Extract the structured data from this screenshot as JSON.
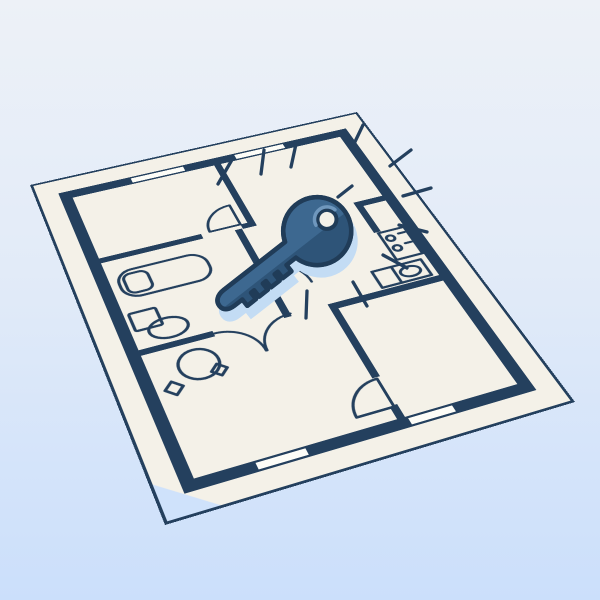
{
  "scene": {
    "description": "Flat vector illustration of an architectural floor plan drawn on a cream sheet laid in perspective, with a large blue door key lying on top surrounded by radiating emphasis lines",
    "text_content": "none"
  },
  "colors": {
    "bg-top": "#edf1f7",
    "bg-mid": "#e2ebf8",
    "bg-bottom": "#cbdffb",
    "paper": "#f4f1e8",
    "paper-bright": "#fdfdf8",
    "ink": "#24405e",
    "key-fill": "#3d6890",
    "key-dark": "#2e5478",
    "key-outline": "#203c58",
    "key-highlight": "#6f97bd",
    "key-shadow": "#c3dcf4",
    "notch": "#cfe2fb"
  },
  "floor_plan": {
    "windows": 4,
    "door_arcs": 5,
    "fixtures": [
      "bathtub",
      "toilet",
      "dining-table",
      "dining-stools",
      "stove",
      "kitchen-sink"
    ],
    "rooms": [
      "bedroom-top-left",
      "room-top-right",
      "bathroom",
      "kitchen",
      "room-bottom-left",
      "room-bottom-right",
      "hallway"
    ]
  },
  "key": {
    "type": "classic-door-key",
    "teeth": 4,
    "burst_lines": 12,
    "orientation": "head upper-right, tip lower-left"
  }
}
